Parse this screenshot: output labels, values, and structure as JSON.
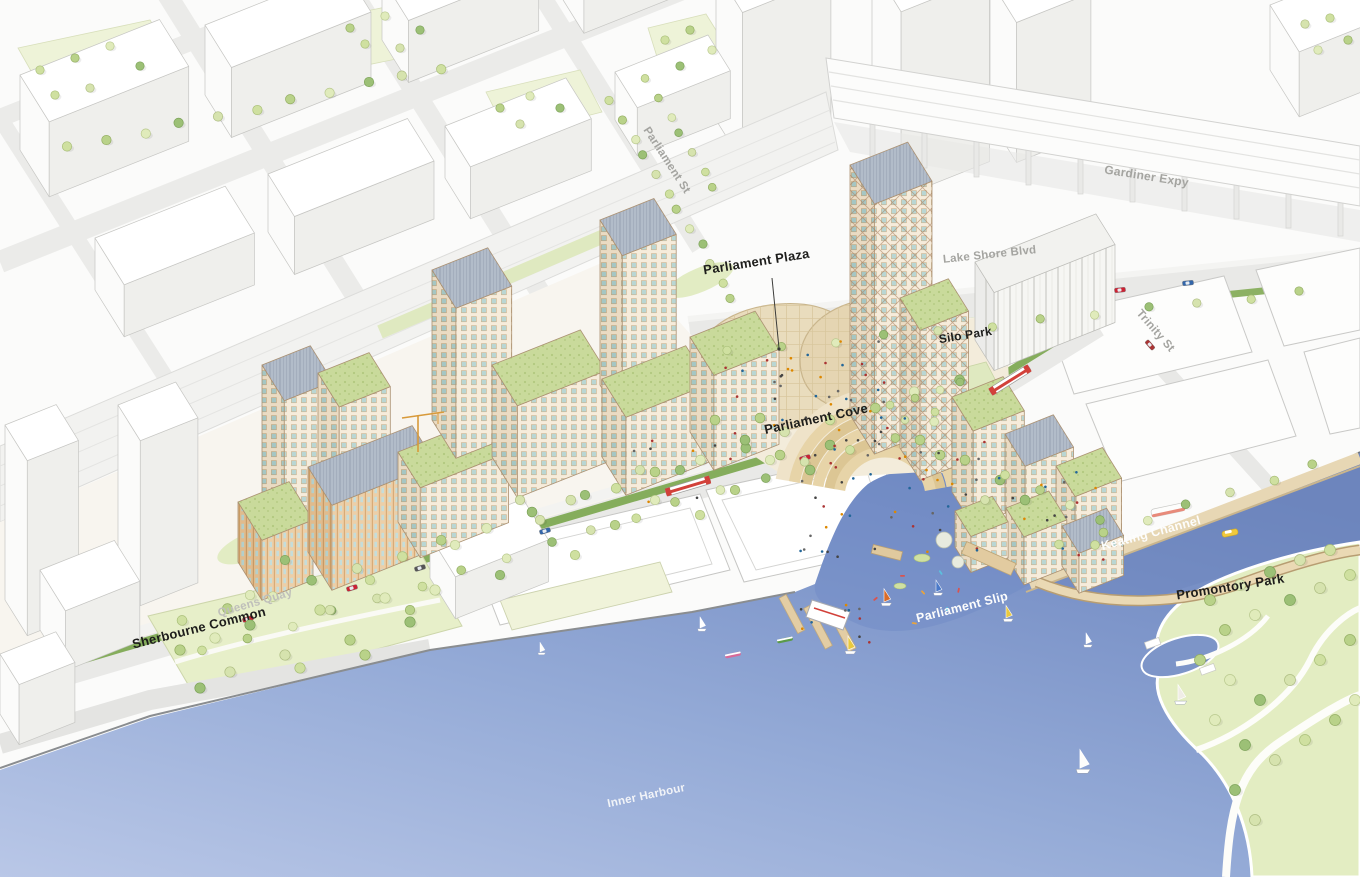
{
  "labels": {
    "parliament_st": "Parliament St",
    "gardiner_expy": "Gardiner Expy",
    "lake_shore_blvd": "Lake Shore Blvd",
    "trinity_st": "Trinity St",
    "parliament_plaza": "Parliament Plaza",
    "silo_park": "Silo Park",
    "parliament_cove": "Parliament Cove",
    "parliament_slip": "Parliament Slip",
    "keating_channel": "Keating Channel",
    "promontory_park": "Promontory Park",
    "queens_quay": "Queens Quay",
    "sherbourne_common": "Sherbourne Common",
    "inner_harbour": "Inner Harbour"
  },
  "colors": {
    "water_shallow": "#b9c7e7",
    "water_deep": "#6c85bd",
    "park_green": "#e7efc9",
    "tree_green": "#cfe0a0",
    "road_gray": "#e9e9e7",
    "lrt_green": "#85ad5c",
    "facade_tan": "#f6ecdb",
    "window_teal": "#b9d6d3",
    "warm_timber": "#eccfa8",
    "canopy_tan": "#e9dcbd",
    "boardwalk_tan": "#e3cda4",
    "streetcar_red": "#d2413a",
    "label_dark": "#1d1d1b",
    "label_muted": "#a4a4a0",
    "label_light": "#fdfdfc"
  }
}
